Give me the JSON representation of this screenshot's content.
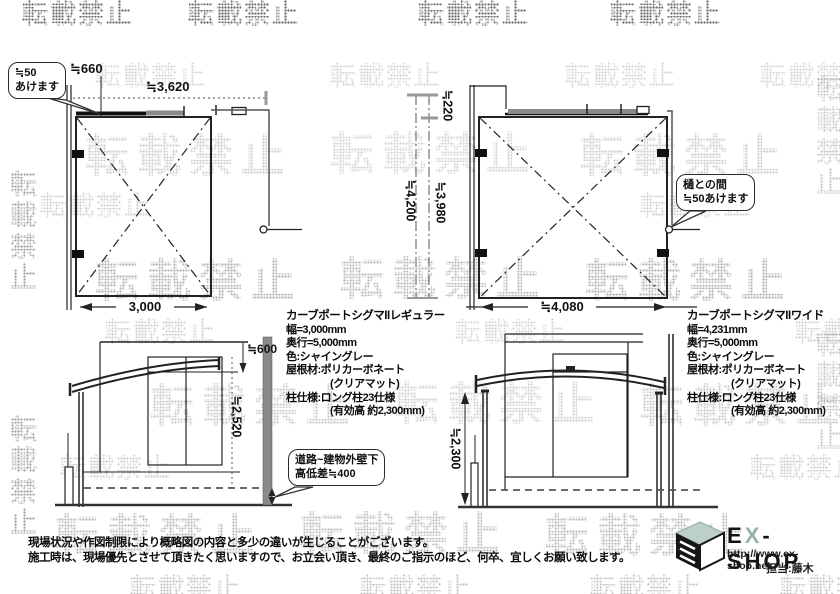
{
  "watermarks": {
    "text": "転載禁止",
    "instances": [
      {
        "x": 22,
        "y": -6,
        "s": 26,
        "o": 0.8
      },
      {
        "x": 188,
        "y": -6,
        "s": 26,
        "o": 0.8
      },
      {
        "x": 418,
        "y": -6,
        "s": 26,
        "o": 0.8
      },
      {
        "x": 610,
        "y": -6,
        "s": 26,
        "o": 0.8
      },
      {
        "x": 95,
        "y": 56,
        "s": 26,
        "o": 0.22
      },
      {
        "x": 330,
        "y": 56,
        "s": 26,
        "o": 0.22
      },
      {
        "x": 565,
        "y": 56,
        "s": 26,
        "o": 0.22
      },
      {
        "x": 760,
        "y": 56,
        "s": 26,
        "o": 0.22
      },
      {
        "x": 40,
        "y": 186,
        "s": 26,
        "o": 0.25
      },
      {
        "x": 640,
        "y": 186,
        "s": 26,
        "o": 0.25
      },
      {
        "x": 105,
        "y": 312,
        "s": 26,
        "o": 0.25
      },
      {
        "x": 455,
        "y": 312,
        "s": 26,
        "o": 0.22
      },
      {
        "x": 795,
        "y": 312,
        "s": 26,
        "o": 0.25
      },
      {
        "x": 60,
        "y": 448,
        "s": 26,
        "o": 0.25
      },
      {
        "x": 750,
        "y": 448,
        "s": 26,
        "o": 0.25
      },
      {
        "x": 130,
        "y": 568,
        "s": 26,
        "o": 0.3
      },
      {
        "x": 360,
        "y": 568,
        "s": 26,
        "o": 0.3
      },
      {
        "x": 590,
        "y": 568,
        "s": 26,
        "o": 0.3
      },
      {
        "x": 780,
        "y": 568,
        "s": 26,
        "o": 0.3
      },
      {
        "x": 85,
        "y": 120,
        "s": 44,
        "o": 0.26,
        "big": 1
      },
      {
        "x": 330,
        "y": 118,
        "s": 44,
        "o": 0.22,
        "big": 1
      },
      {
        "x": 580,
        "y": 120,
        "s": 44,
        "o": 0.26,
        "big": 1
      },
      {
        "x": 95,
        "y": 245,
        "s": 44,
        "o": 0.4,
        "big": 1
      },
      {
        "x": 340,
        "y": 243,
        "s": 44,
        "o": 0.36,
        "big": 1
      },
      {
        "x": 585,
        "y": 245,
        "s": 44,
        "o": 0.4,
        "big": 1
      },
      {
        "x": 150,
        "y": 370,
        "s": 44,
        "o": 0.28,
        "big": 1
      },
      {
        "x": 395,
        "y": 368,
        "s": 44,
        "o": 0.24,
        "big": 1
      },
      {
        "x": 640,
        "y": 370,
        "s": 44,
        "o": 0.28,
        "big": 1
      },
      {
        "x": 55,
        "y": 500,
        "s": 44,
        "o": 0.36,
        "big": 1
      },
      {
        "x": 300,
        "y": 498,
        "s": 44,
        "o": 0.34,
        "big": 1
      },
      {
        "x": 545,
        "y": 500,
        "s": 44,
        "o": 0.36,
        "big": 1
      },
      {
        "x": 2,
        "y": 170,
        "s": 27,
        "o": 0.5,
        "v": 1
      },
      {
        "x": 2,
        "y": 415,
        "s": 27,
        "o": 0.5,
        "v": 1
      },
      {
        "x": 808,
        "y": 75,
        "s": 27,
        "o": 0.3,
        "v": 1
      },
      {
        "x": 808,
        "y": 330,
        "s": 27,
        "o": 0.3,
        "v": 1
      }
    ]
  },
  "plan_regular": {
    "bubble_l1": "≒50",
    "bubble_l2": "あけます",
    "dim_offset": "≒660",
    "dim_total": "≒3,620",
    "dim_width": "3,000"
  },
  "mid_dims": {
    "dim_gap": "≒220",
    "dim_overall": "≒4,200",
    "dim_depth": "≒3,980"
  },
  "plan_wide": {
    "bubble_l1": "樋との間",
    "bubble_l2": "≒50あけます",
    "dim_width": "≒4,080"
  },
  "spec_regular": {
    "title": "カーブポートシグマIIレギュラー",
    "lines": [
      "幅=3,000mm",
      "奥行=5,000mm",
      "色:シャイングレー",
      "屋根材:ポリカーボネート",
      "(クリアマット)",
      "柱仕様:ロング柱23仕様",
      "(有効高 約2,300mm)"
    ]
  },
  "spec_wide": {
    "title": "カーブポートシグマIIワイド",
    "lines": [
      "幅=4,231mm",
      "奥行=5,000mm",
      "色:シャイングレー",
      "屋根材:ポリカーボネート",
      "(クリアマット)",
      "柱仕様:ロング柱23仕様",
      "(有効高 約2,300mm)"
    ]
  },
  "elevation_side": {
    "dim_eave": "≒600",
    "dim_height": "≒2,520",
    "bubble_l1": "道路~建物外壁下",
    "bubble_l2": "高低差≒400"
  },
  "elevation_front": {
    "dim_height": "≒2,300"
  },
  "notes": {
    "line1": "現場状況や作図制限により概略図の内容と多少の違いが生じることがございます。",
    "line2": "施工時は、現場優先とさせて頂きたく思いますので、お立会い頂き、最終のご指示のほど、何卒、宜しくお願い致します。"
  },
  "logo": {
    "brand_e": "E",
    "brand_x": "X",
    "brand_rest": "-SHOP",
    "url": "http://www.ex-shop.net",
    "contact": "担当:藤木"
  },
  "colors": {
    "line": "#222222",
    "beam_gray": "#8a8a8a",
    "wall_fill": "#8a8a8a",
    "logo_teal": "#bccfcb",
    "brand_x_color": "#92b2ae"
  }
}
